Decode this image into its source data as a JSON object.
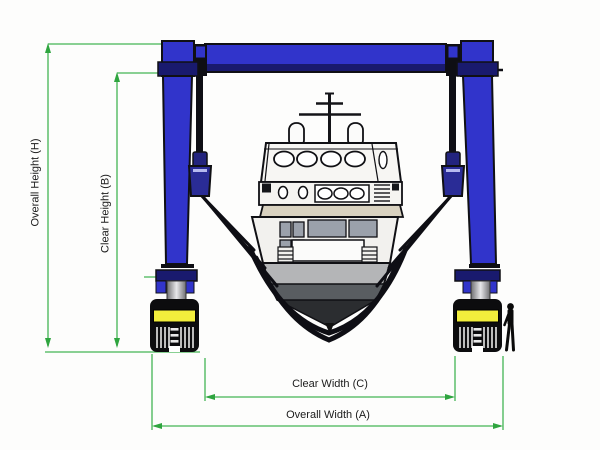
{
  "diagram": {
    "subject": "Mobile boat hoist gantry crane lifting a boat in slings, front view with dimension annotations",
    "labels": {
      "overall_height": "Overall Height (H)",
      "clear_height": "Clear Height (B)",
      "clear_width": "Clear Width (C)",
      "overall_width": "Overall Width (A)"
    },
    "colors": {
      "dimension_line": "#44b554",
      "dimension_arrow": "#2fa53f",
      "crane_blue": "#3134cb",
      "crane_navy": "#191a6e",
      "wheel_yellow": "#f2ee3c",
      "outline": "#101014",
      "hull_light_gray": "#b4b5b7",
      "hull_mid_gray": "#595d61",
      "hull_dark_gray": "#2b2d30",
      "deck_cream": "#d9d2c0",
      "background": "#fdfdfc"
    }
  }
}
